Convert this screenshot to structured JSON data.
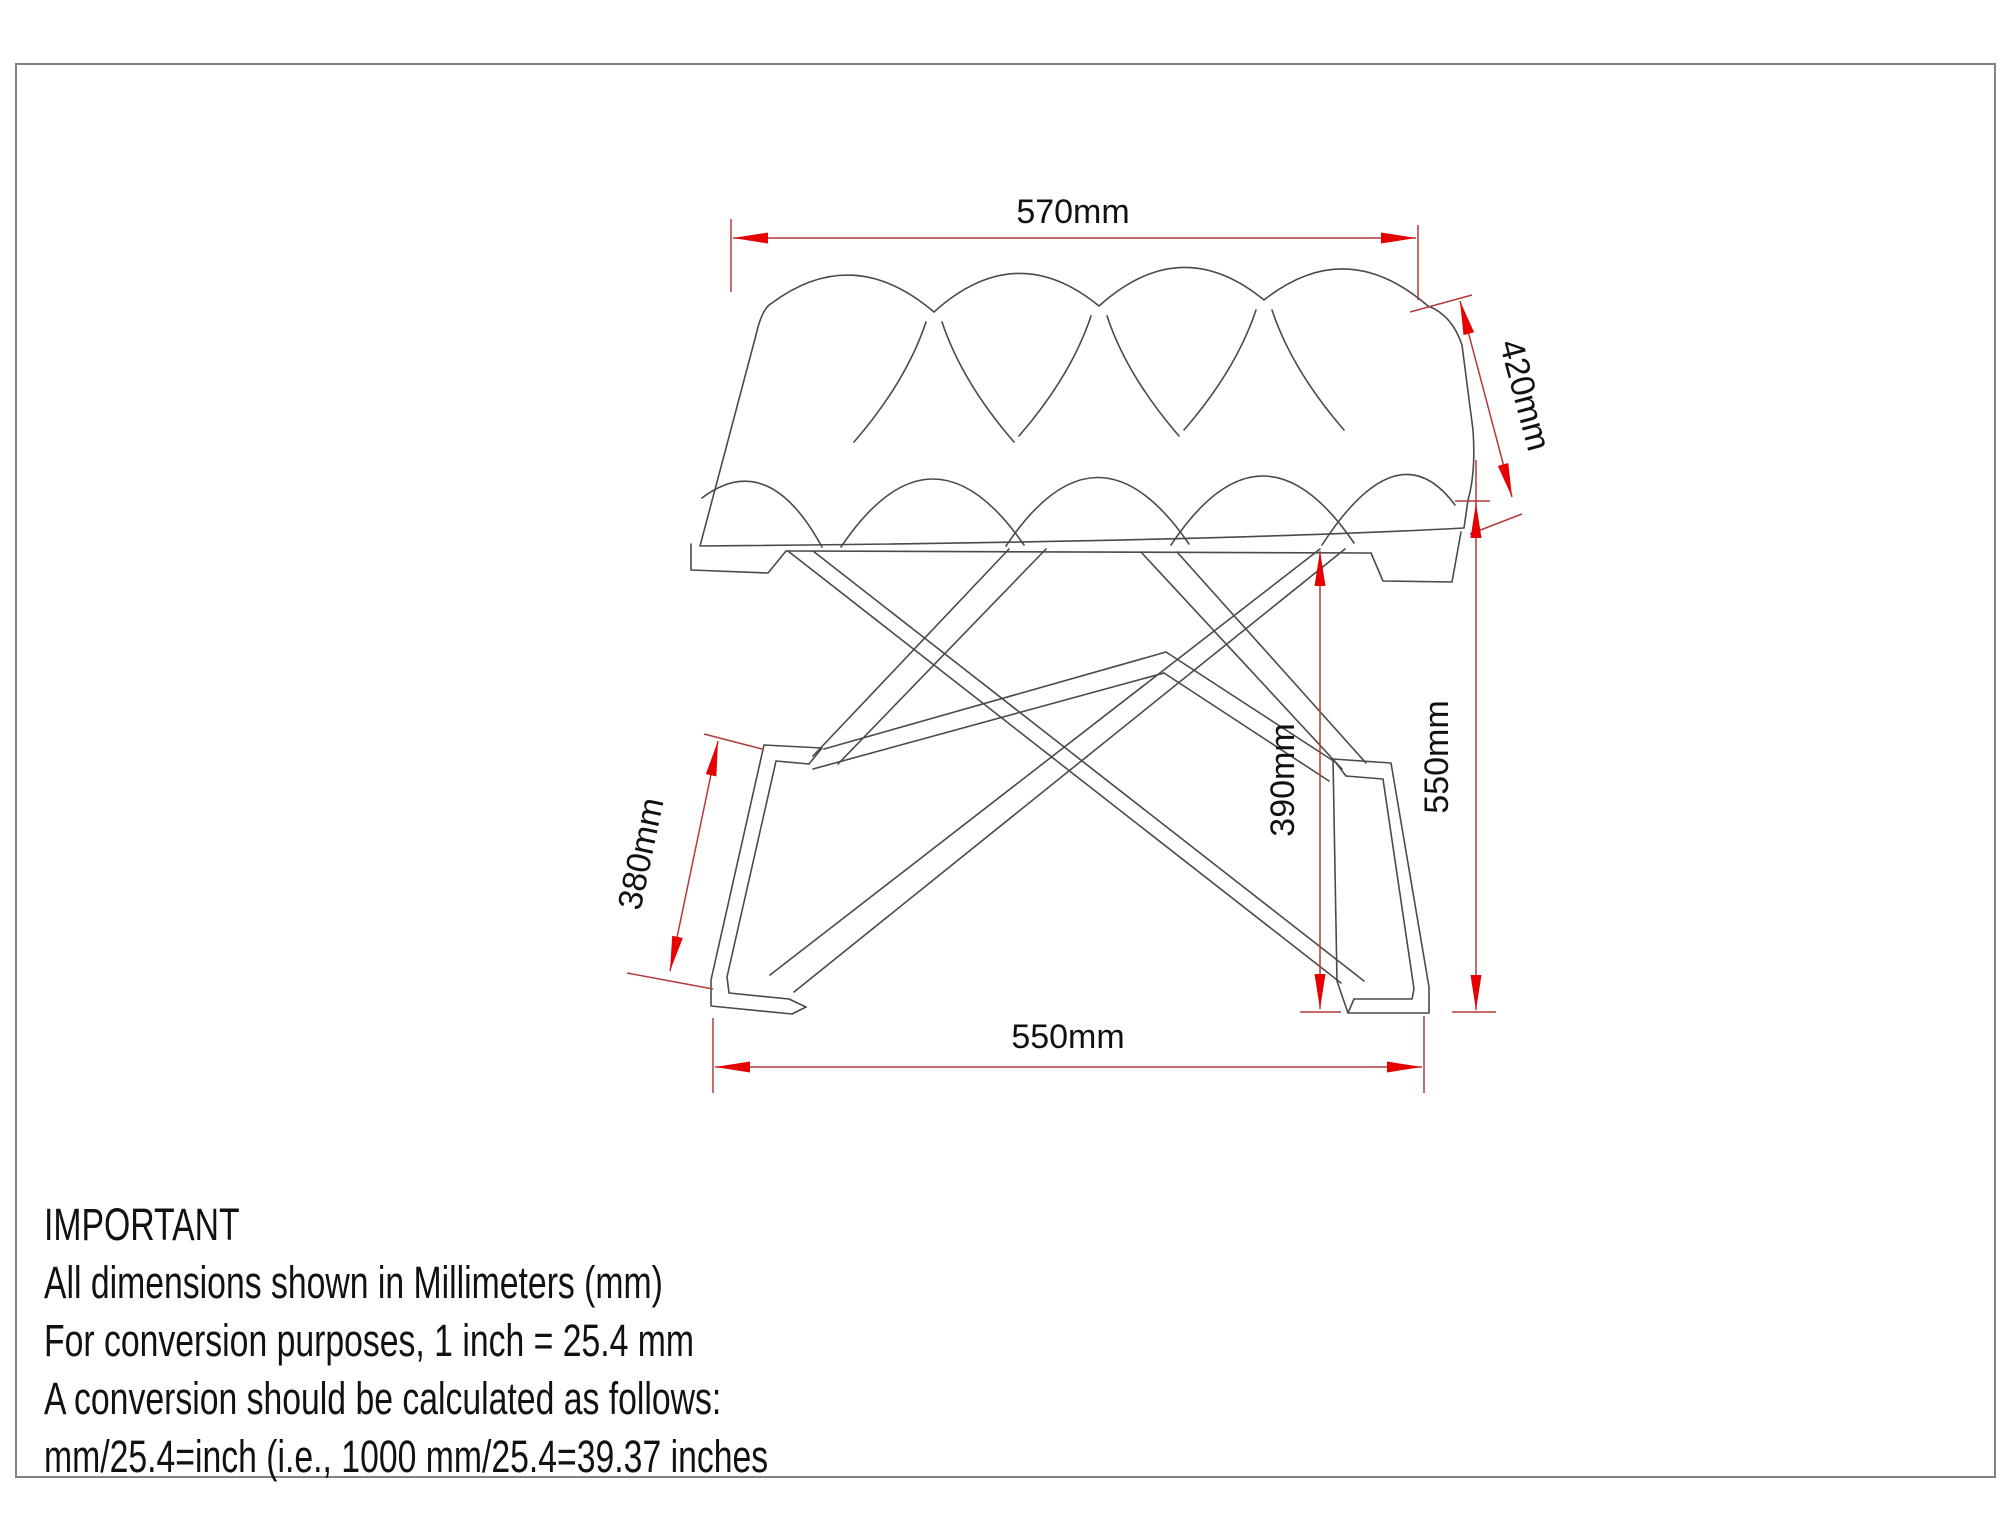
{
  "drawing": {
    "type": "technical-drawing",
    "subject": "tufted-top X-frame bench stool, perspective line drawing",
    "units": "mm",
    "dimensions": {
      "seat_width": "570mm",
      "seat_depth": "420mm",
      "overall_height": "550mm",
      "frame_clearance_height": "390mm",
      "foot_height": "380mm",
      "base_width": "550mm"
    },
    "colors": {
      "dimension_line": "#b23a3a",
      "arrow": "#e60000",
      "outline": "#4a4a4a",
      "border": "#828282",
      "text": "#111111"
    }
  },
  "notes": {
    "title": "IMPORTANT",
    "lines": [
      "All dimensions shown in Millimeters (mm)",
      "For conversion purposes, 1 inch = 25.4 mm",
      "A conversion should be calculated as follows:",
      "mm/25.4=inch (i.e., 1000 mm/25.4=39.37 inches"
    ]
  }
}
